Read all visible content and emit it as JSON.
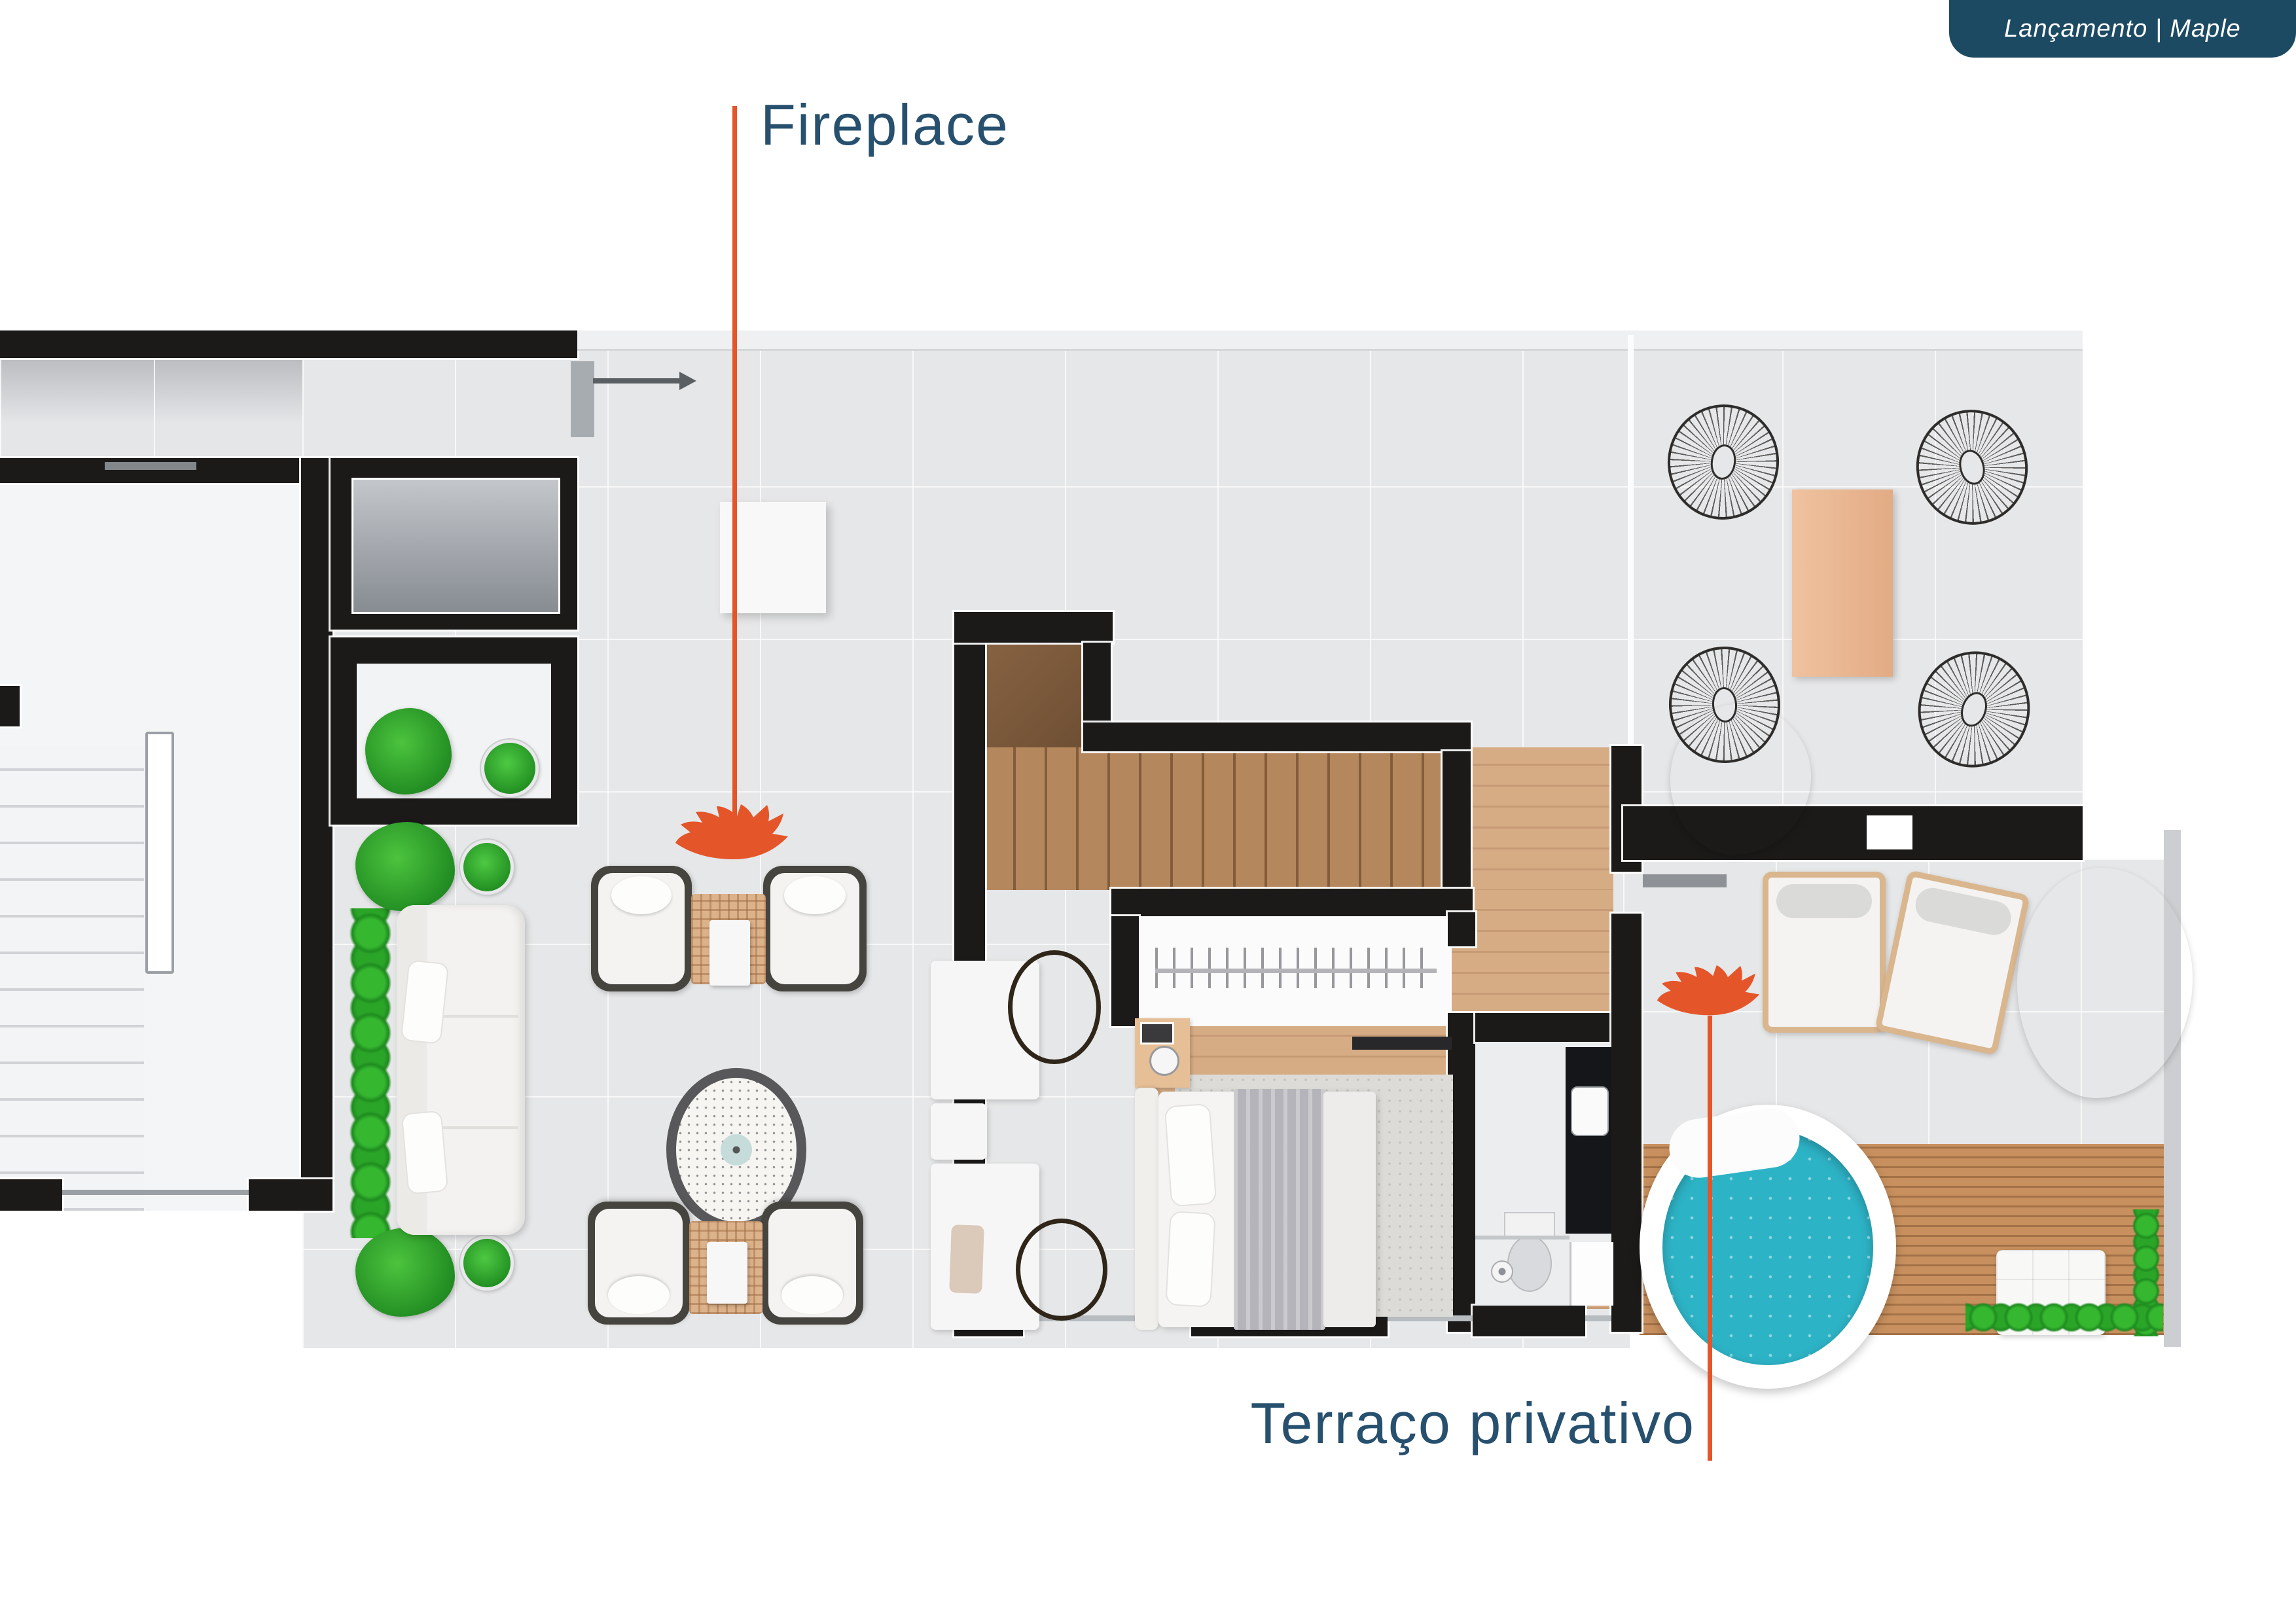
{
  "badge": {
    "text": "Lançamento | Maple"
  },
  "annotations": {
    "fireplace": {
      "label": "Fireplace"
    },
    "terrace": {
      "label": "Terraço privativo"
    }
  },
  "icons": {
    "fireplace_marker": "maple-leaf-icon",
    "terrace_marker": "maple-leaf-icon"
  },
  "colors": {
    "page_bg": "#ffffff",
    "badge_bg": "#1d4a63",
    "label_text": "#27506e",
    "accent_orange": "#e4552a",
    "wall_black": "#1b1a19",
    "tile_floor": "#e6e7e8",
    "wood_floor": "#d6ac85",
    "stair_wood": "#b5875d",
    "deck_wood": "#c8905e",
    "pool_water": "#2db3c6",
    "hedge_green": "#2fae2b"
  }
}
